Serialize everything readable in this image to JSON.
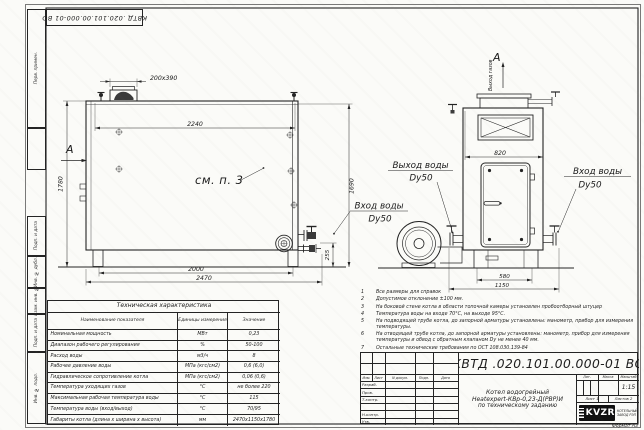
{
  "stamps_left": [
    "Перв. примен.",
    "Подп. и дата",
    "Инв. № дубл.",
    "Взам. инв. №",
    "Подп. и дата",
    "Инв. № подл."
  ],
  "views": {
    "view_label_a": "А",
    "gas_outlet": "Выход газов",
    "see_note": "см. п. 3",
    "water_outlet": "Выход воды",
    "water_inlet": "Вход воды",
    "dy": "Dy50"
  },
  "dims": {
    "flue": "200х390",
    "top": "2240",
    "left_h": "1780",
    "right_h": "1690",
    "pipe": "255",
    "span": "2000",
    "length": "2470",
    "width": "820",
    "base": "580",
    "front": "1150"
  },
  "notes": [
    {
      "n": "1",
      "text": "Все размеры для справок"
    },
    {
      "n": "2",
      "text": "Допустимое отклонение ±100 мм."
    },
    {
      "n": "3",
      "text": "На боковой стене котла в области топочной камеры установлен пробоотборный штуцер"
    },
    {
      "n": "4",
      "text": "Температура воды на входе 70°С, на выходе 95°С."
    },
    {
      "n": "5",
      "text": "На подводящей трубе котла, до запорной арматуры установлены: манометр, прибор для измерения температуры."
    },
    {
      "n": "6",
      "text": "На отводящей трубе котла, до запорной арматуры установлены: манометр, прибор для измерения температуры и обвод с обратным клапаном Dу не менее 40 мм."
    },
    {
      "n": "7",
      "text": "Остальные технические требования по ОСТ 108.030.139-84"
    }
  ],
  "table": {
    "title": "Техническая характеристика",
    "col_name": "Наименование показателя",
    "col_units": "Единицы измерения",
    "col_value": "Значение",
    "rows": [
      {
        "name": "Номинальная мощность",
        "units": "МВт",
        "value": "0,23"
      },
      {
        "name": "Диапазон рабочего регулирования",
        "units": "%",
        "value": "50-100"
      },
      {
        "name": "Расход воды",
        "units": "м3/ч",
        "value": "8"
      },
      {
        "name": "Рабочее давление воды",
        "units": "МПа (кгс/см2)",
        "value": "0,6 (6,0)"
      },
      {
        "name": "Гидравлическое сопротивление котла",
        "units": "МПа (кгс/см2)",
        "value": "0,06 (0,6)"
      },
      {
        "name": "Температура уходящих газов",
        "units": "°С",
        "value": "не более 220"
      },
      {
        "name": "Максимальная рабочая температура воды",
        "units": "°С",
        "value": "115"
      },
      {
        "name": "Температура воды (вход/выход)",
        "units": "°С",
        "value": "70/95"
      },
      {
        "name": "Габариты котла (длина х ширина х высота)",
        "units": "мм",
        "value": "2470х1150х1780"
      }
    ]
  },
  "title_block": {
    "designation": "КВТД .020.101.00.000-01  ВО",
    "product_line1": "Котел водогрейный",
    "product_line2": "Heatexpert-КВр-0,23-Д(РВР)И",
    "product_line3": "по техническому заданию",
    "hdr_izm": "Изм.",
    "hdr_list": "Лист",
    "hdr_doc": "N докум.",
    "hdr_sign": "Подп.",
    "hdr_date": "Дата",
    "row_razrab": "Разраб.",
    "row_prov": "Пров.",
    "row_tkontr": "Т.контр.",
    "row_nkontr": "Н.контр.",
    "row_utv": "Утв.",
    "hdr_lit": "Лит.",
    "hdr_mass": "Масса",
    "hdr_scale": "Масштаб",
    "scale": "1:15",
    "sheet": "Лист 1",
    "sheets": "Листов 2",
    "logo": "KVZR",
    "logo_text1": "КОТЕЛЬНЫЙ",
    "logo_text2": "ЗАВОД РЭП",
    "format": "Формат А3"
  }
}
